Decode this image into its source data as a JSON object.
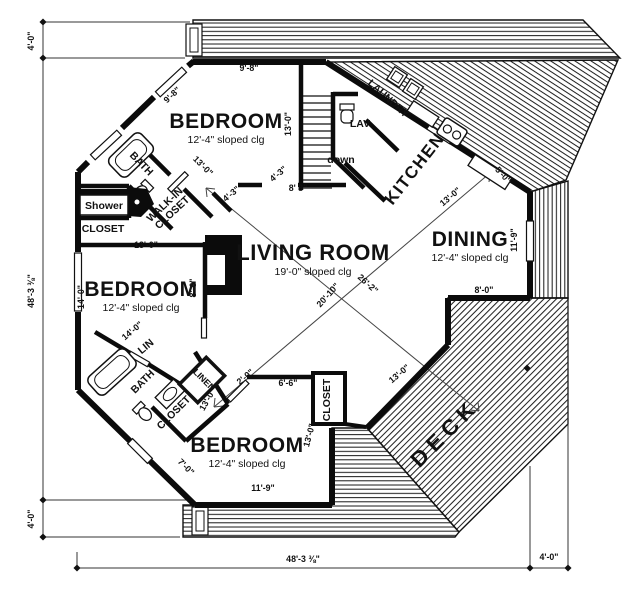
{
  "plan": {
    "colors": {
      "ink": "#111111",
      "paper": "#ffffff"
    },
    "rooms": [
      {
        "id": "bedroom-1",
        "name": "BEDROOM",
        "sub": "12'-4\" sloped clg",
        "x": 226,
        "y": 128,
        "rot": 0
      },
      {
        "id": "bedroom-2",
        "name": "BEDROOM",
        "sub": "12'-4\" sloped clg",
        "x": 141,
        "y": 296,
        "rot": 0
      },
      {
        "id": "bedroom-3",
        "name": "BEDROOM",
        "sub": "12'-4\" sloped clg",
        "x": 247,
        "y": 452,
        "rot": 0
      },
      {
        "id": "living-room",
        "name": "LIVING ROOM",
        "sub": "19'-0\" sloped clg",
        "x": 313,
        "y": 260,
        "rot": 0,
        "cls": "living"
      },
      {
        "id": "dining",
        "name": "DINING",
        "sub": "12'-4\" sloped clg",
        "x": 470,
        "y": 246,
        "rot": 0
      },
      {
        "id": "kitchen",
        "name": "KITCHEN",
        "x": 419,
        "y": 172,
        "rot": -52,
        "cls": "k"
      },
      {
        "id": "deck",
        "name": "DECK",
        "x": 450,
        "y": 438,
        "rot": -45,
        "cls": "deck-big"
      }
    ],
    "labels": [
      {
        "id": "laundry",
        "t": "LAUNDRY",
        "x": 386,
        "y": 101,
        "r": 42
      },
      {
        "id": "lav",
        "t": "LAV",
        "x": 360,
        "y": 127,
        "r": 0
      },
      {
        "id": "stairs-down",
        "t": "down",
        "x": 341,
        "y": 163,
        "r": 0
      },
      {
        "id": "bath-upper",
        "t": "BATH",
        "x": 139,
        "y": 166,
        "r": 46
      },
      {
        "id": "shower",
        "t": "Shower",
        "x": 104,
        "y": 209,
        "r": 0
      },
      {
        "id": "closet-left",
        "t": "CLOSET",
        "x": 103,
        "y": 232,
        "r": 0
      },
      {
        "id": "walk-in-closet",
        "lines": [
          "WALK-IN",
          "CLOSET"
        ],
        "x": 167,
        "y": 207,
        "r": -43
      },
      {
        "id": "lin",
        "t": "LIN",
        "x": 148,
        "y": 349,
        "r": -40
      },
      {
        "id": "bath-lower",
        "t": "BATH",
        "x": 145,
        "y": 384,
        "r": -45
      },
      {
        "id": "linen",
        "t": "LINEN",
        "x": 202,
        "y": 382,
        "r": 45,
        "cls": "lbl-sm"
      },
      {
        "id": "closet-lower-left",
        "t": "CLOSET",
        "x": 176,
        "y": 415,
        "r": -45
      },
      {
        "id": "closet-bedroom3",
        "t": "CLOSET",
        "x": 330,
        "y": 400,
        "r": -90
      }
    ],
    "dimensions": [
      {
        "t": "4'-0\"",
        "x": 34,
        "y": 41,
        "r": -90
      },
      {
        "t": "48'-3 ⅜\"",
        "x": 34,
        "y": 291,
        "r": -90
      },
      {
        "t": "4'-0\"",
        "x": 34,
        "y": 519,
        "r": -90
      },
      {
        "t": "48'-3 ⅜\"",
        "x": 303,
        "y": 562,
        "r": 0
      },
      {
        "t": "4'-0\"",
        "x": 549,
        "y": 560,
        "r": 0
      },
      {
        "t": "9'-8\"",
        "x": 249,
        "y": 71,
        "r": 0
      },
      {
        "t": "9'-8\"",
        "x": 174,
        "y": 97,
        "r": -43
      },
      {
        "t": "13'-0\"",
        "x": 291,
        "y": 124,
        "r": -90
      },
      {
        "t": "4'-3\"",
        "x": 280,
        "y": 176,
        "r": -40
      },
      {
        "t": "4'-3\"",
        "x": 233,
        "y": 196,
        "r": -40
      },
      {
        "t": "8' 8\"",
        "x": 298,
        "y": 191,
        "r": 0
      },
      {
        "t": "13'-0\"",
        "x": 452,
        "y": 199,
        "r": -40
      },
      {
        "t": "5'-0\"",
        "x": 501,
        "y": 177,
        "r": 48
      },
      {
        "t": "11'-9\"",
        "x": 517,
        "y": 240,
        "r": -90
      },
      {
        "t": "8'-0\"",
        "x": 484,
        "y": 293,
        "r": 0
      },
      {
        "t": "13'-0\"",
        "x": 401,
        "y": 376,
        "r": -40
      },
      {
        "t": "13'-0\"",
        "x": 312,
        "y": 436,
        "r": -75
      },
      {
        "t": "13'-0\"",
        "x": 201,
        "y": 168,
        "r": 45
      },
      {
        "t": "13'-0\"",
        "x": 146,
        "y": 248,
        "r": 0
      },
      {
        "t": "14'-0\"",
        "x": 84,
        "y": 297,
        "r": -90
      },
      {
        "t": "8'-6\"",
        "x": 196,
        "y": 288,
        "r": -90
      },
      {
        "t": "14'-0\"",
        "x": 134,
        "y": 333,
        "r": -40
      },
      {
        "t": "13'-0\"",
        "x": 210,
        "y": 401,
        "r": -60
      },
      {
        "t": "2'-0\"",
        "x": 247,
        "y": 379,
        "r": -40
      },
      {
        "t": "6'-6\"",
        "x": 288,
        "y": 386,
        "r": 0
      },
      {
        "t": "7'-0\"",
        "x": 184,
        "y": 469,
        "r": 45
      },
      {
        "t": "11'-9\"",
        "x": 263,
        "y": 491,
        "r": 0
      },
      {
        "t": "20'-10\"",
        "x": 330,
        "y": 297,
        "r": -48
      },
      {
        "t": "26'-2\"",
        "x": 366,
        "y": 286,
        "r": 42
      }
    ],
    "fixtures": [
      "bathtub-icon",
      "toilet-icon",
      "shower-pan-icon",
      "vanity-sink-icon",
      "stove-burners-icon",
      "washer-dryer-icon",
      "fireplace-icon",
      "staircase-icon"
    ]
  }
}
